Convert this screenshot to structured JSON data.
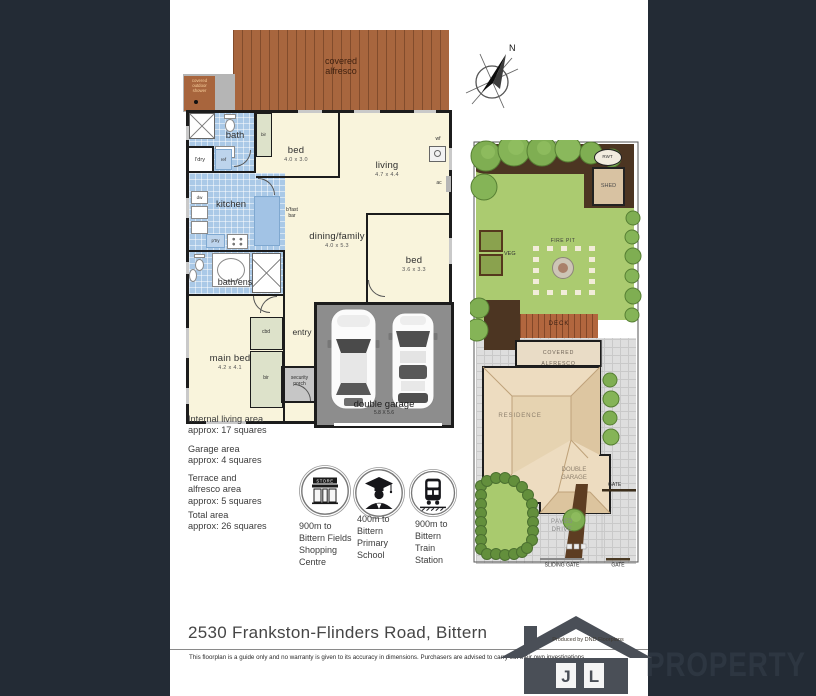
{
  "page": {
    "title": "2530 Frankston-Flinders Road, Bittern",
    "disclaimer": "This floorplan is a guide only and no warranty is given to its accuracy in dimensions.  Purchasers are advised to carry out their own investigations",
    "produced_by": "Produced by DND Floorplans"
  },
  "brand": {
    "letter_j": "J",
    "letter_l": "L",
    "name": "PROPERTY"
  },
  "compass": {
    "north": "N"
  },
  "floorplan": {
    "covered_alfresco": "covered\nalfresco",
    "covered_outdoor_shower": "covered\noutdoor\nshower",
    "bath": "bath",
    "ldry": "l'dry",
    "ref": "ref",
    "bir_top": "bir",
    "bed1": "bed",
    "bed1_dims": "4.0 x 3.0",
    "living": "living",
    "living_dims": "4.7 x 4.4",
    "wf": "wf",
    "ac": "ac",
    "dw": "dw",
    "kitchen": "kitchen",
    "bfast_bar": "b'fast\nbar",
    "ptry": "p'try",
    "dining": "dining/family",
    "dining_dims": "4.0 x 5.3",
    "bed2": "bed",
    "bed2_dims": "3.6 x 3.3",
    "bath_ens": "bath/ens",
    "main_bed": "main bed",
    "main_bed_dims": "4.2 x 4.1",
    "cbd": "cbd",
    "bir_bottom": "bir",
    "entry": "entry",
    "security_porch": "security\nporch",
    "garage": "double garage",
    "garage_dims": "5.8 X 5.6"
  },
  "areas": [
    {
      "label": "Internal living area",
      "value": "approx: 17 squares"
    },
    {
      "label": "Garage area",
      "value": "approx: 4 squares"
    },
    {
      "label": "Terrace and\nalfresco area",
      "value": "approx: 5 squares"
    },
    {
      "label": "Total area",
      "value": "approx: 26 squares"
    }
  ],
  "amenities": [
    {
      "sign": "STORE",
      "text": "900m to\nBittern Fields\nShopping\nCentre"
    },
    {
      "text": "400m to\nBittern\nPrimary\nSchool"
    },
    {
      "text": "900m to\nBittern\nTrain\nStation"
    }
  ],
  "siteplan": {
    "rwt": "RWT",
    "shed": "SHED",
    "veg": "VEG",
    "fire_pit": "FIRE PIT",
    "deck": "DECK",
    "covered_alfresco_line1": "COVERED",
    "covered_alfresco_line2": "ALFRESCO",
    "residence": "RESIDENCE",
    "double_garage_line1": "DOUBLE",
    "double_garage_line2": "GARAGE",
    "gate_side": "GATE",
    "paved_drive_line1": "PAVED",
    "paved_drive_line2": "DRIVE",
    "sliding_gate": "SLIDING GATE",
    "gate_front": "GATE"
  },
  "colors": {
    "frame_navy": "#232b35",
    "room_cream": "#f9f4dc",
    "wet_area_blue": "#aac9e7",
    "alfresco_brown": "#a8663e",
    "garage_grey": "#8d8d8d",
    "lawn_green": "#a9ca6e",
    "brand_text": "#2d3641"
  }
}
